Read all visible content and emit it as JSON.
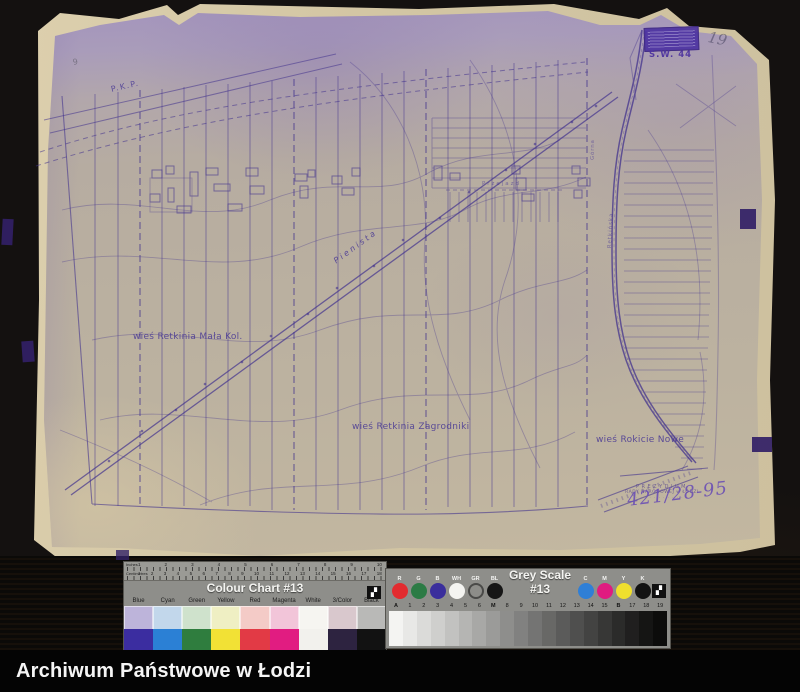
{
  "map": {
    "ink_color": "#43338e",
    "stamp_color": "#4c32a2",
    "labels": {
      "pkp": "P.K.P.",
      "pienista": "Pienista",
      "village_left": "wieś Retkinia Mała Kol.",
      "village_center": "wieś Retkinia Zagrodniki",
      "village_right": "wieś Rokicie Nowe",
      "street_vertical": "Retkińska",
      "boundary_vertical": "Górna",
      "road_small": "Przejazd",
      "stamp_code": "S.W. 44",
      "pencil_note_top": "19",
      "pencil_note_corner": "9",
      "stamp_line1": "PREZYDIUM",
      "stamp_line2": "RADY NARODOWEJ w ŁODZI",
      "stamp_line3": "· · · · · · · · · · · ·",
      "archive_number": "421/28-95"
    }
  },
  "colour_chart": {
    "title": "Colour Chart #13",
    "ruler_unit_top": "Inches",
    "ruler_unit_bottom": "Centimetres",
    "inch_numbers": [
      "1",
      "2",
      "3",
      "4",
      "5",
      "6",
      "7",
      "8",
      "9",
      "10"
    ],
    "cm_numbers": [
      "1",
      "2",
      "3",
      "4",
      "5",
      "6",
      "7",
      "8",
      "9",
      "10",
      "11",
      "12",
      "13",
      "14",
      "15",
      "16",
      "17",
      "18"
    ],
    "logo_glyph": "▞",
    "columns": [
      {
        "label": "Blue",
        "light": "#bdb4da",
        "dark": "#3b2da0"
      },
      {
        "label": "Cyan",
        "light": "#c2d7eb",
        "dark": "#2b80d5"
      },
      {
        "label": "Green",
        "light": "#cfe2cc",
        "dark": "#2f7d3e"
      },
      {
        "label": "Yellow",
        "light": "#efefc3",
        "dark": "#f2e135"
      },
      {
        "label": "Red",
        "light": "#f4cbc7",
        "dark": "#e23a45"
      },
      {
        "label": "Magenta",
        "light": "#f2c5d9",
        "dark": "#e11c81"
      },
      {
        "label": "White",
        "light": "#f6f5f1",
        "dark": "#f2f1ed"
      },
      {
        "label": "3/Color",
        "light": "#d9c8cd",
        "dark": "#2d2340"
      },
      {
        "label": "Black",
        "light": "#b9b9b7",
        "dark": "#121212"
      }
    ]
  },
  "grey_scale": {
    "title": "Grey Scale #13",
    "logo_glyph": "▞",
    "left_patches": [
      {
        "label": "R",
        "color": "#e22b2f"
      },
      {
        "label": "G",
        "color": "#2c7b45"
      },
      {
        "label": "B",
        "color": "#3a2e9c"
      },
      {
        "label": "WH",
        "color": "#f4f4f1"
      },
      {
        "label": "GR",
        "color": "#8d8d89",
        "ring": "#4a4a48"
      },
      {
        "label": "BL",
        "color": "#161616"
      }
    ],
    "right_patches": [
      {
        "label": "C",
        "color": "#2f7fd6"
      },
      {
        "label": "M",
        "color": "#e01b80"
      },
      {
        "label": "Y",
        "color": "#efdf2e"
      },
      {
        "label": "K",
        "color": "#131313"
      }
    ],
    "steps": [
      {
        "label": "A",
        "color": "#f4f4f2",
        "weight": "bold"
      },
      {
        "label": "1",
        "color": "#e8e8e6"
      },
      {
        "label": "2",
        "color": "#dbdbd9"
      },
      {
        "label": "3",
        "color": "#cfcfcd"
      },
      {
        "label": "4",
        "color": "#c2c2c0"
      },
      {
        "label": "5",
        "color": "#b5b5b3"
      },
      {
        "label": "6",
        "color": "#a8a8a6"
      },
      {
        "label": "M",
        "color": "#9b9b99",
        "weight": "bold"
      },
      {
        "label": "8",
        "color": "#8e8e8c"
      },
      {
        "label": "9",
        "color": "#818180"
      },
      {
        "label": "10",
        "color": "#747473"
      },
      {
        "label": "11",
        "color": "#686866"
      },
      {
        "label": "12",
        "color": "#5b5b5a"
      },
      {
        "label": "13",
        "color": "#4f4f4e"
      },
      {
        "label": "14",
        "color": "#434342"
      },
      {
        "label": "15",
        "color": "#373736"
      },
      {
        "label": "B",
        "color": "#2b2b2a",
        "weight": "bold"
      },
      {
        "label": "17",
        "color": "#201f1f"
      },
      {
        "label": "18",
        "color": "#151514"
      },
      {
        "label": "19",
        "color": "#0c0c0b"
      }
    ]
  },
  "footer": {
    "label": "Archiwum Państwowe w Łodzi"
  }
}
